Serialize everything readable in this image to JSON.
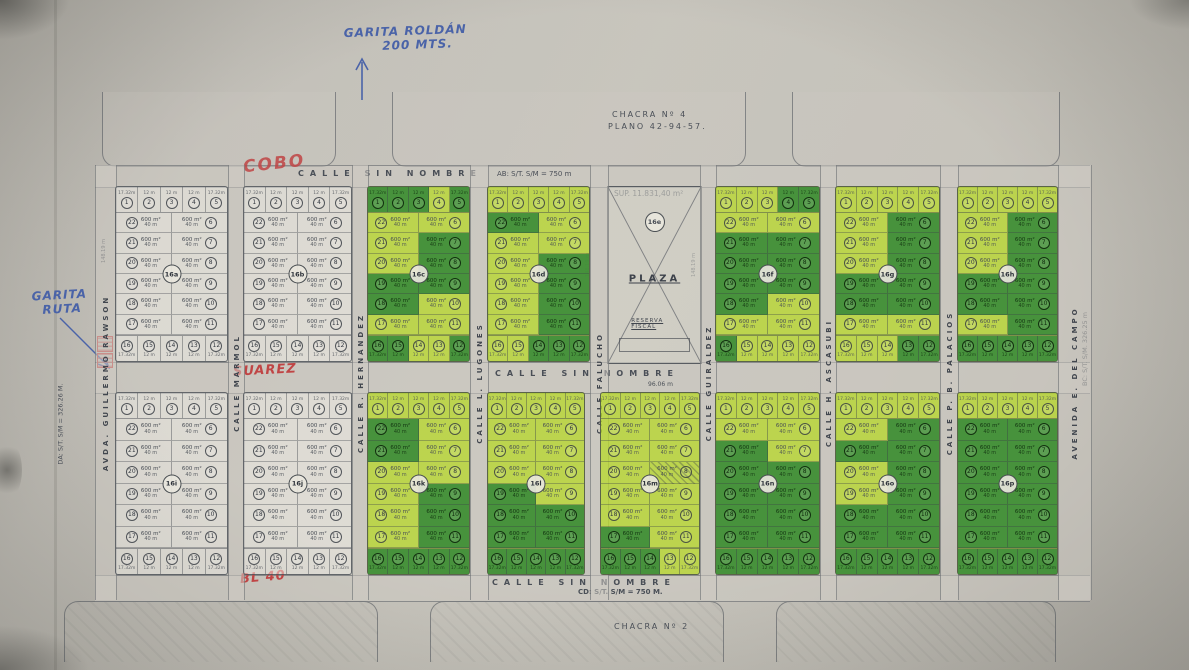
{
  "chacras": {
    "top_name": "CHACRA Nº 4",
    "top_plano": "PLANO 42-94-57.",
    "bottom_name": "CHACRA Nº 2"
  },
  "annotations": {
    "garita_roldan_line1": "GARITA ROLDÁN",
    "garita_roldan_line2": "200 MTS.",
    "garita_ruta_line1": "GARITA",
    "garita_ruta_line2": "RUTA",
    "red_cobo": "COBO",
    "red_suarez": "SUAREZ",
    "red_bl40": "BL 40"
  },
  "measurements": {
    "top_edge": "AB: S/T. S/M = 750 m",
    "bottom_edge": "CD: S/T. S/M = 750 M.",
    "left_edge": "DA: S/T. S/M = 326.26 M.",
    "right_edge": "BC: S/T. S/M. 326.25 m",
    "superficie": "SUP. 11.831,40 m²",
    "block_side": "148.19 m",
    "plaza_bottom": "96.06 m"
  },
  "streets": {
    "unnamed": "CALLE SIN NOMBRE",
    "vertical": [
      "AVDA. GUILLERMO RAWSON",
      "CALLE MARMOL",
      "CALLE R. HERNANDEZ",
      "CALLE L. LUGONES",
      "CALLE FALUCHO",
      "CALLE GUIRALDEZ",
      "CALLE H. ASCASUBI",
      "CALLE P. B. PALACIOS",
      "AVENIDA E. DEL CAMPO"
    ]
  },
  "plaza": {
    "label": "16e",
    "name": "PLAZA",
    "reserve": "RESERVA FISCAL"
  },
  "lot_text": {
    "area": "600 m²",
    "depth": "40 m",
    "strip_width": "12 m",
    "corner_width": "17.32m"
  },
  "numbering": {
    "top_strip": [
      1,
      2,
      3,
      4,
      5
    ],
    "left_col": [
      22,
      21,
      20,
      19,
      18,
      17
    ],
    "right_col": [
      6,
      7,
      8,
      9,
      10,
      11
    ],
    "bottom_strip": [
      16,
      15,
      14,
      13,
      12
    ]
  },
  "blocks_top": [
    {
      "label": "16a",
      "green": false,
      "darks": []
    },
    {
      "label": "16b",
      "green": false,
      "darks": []
    },
    {
      "label": "16c",
      "green": true,
      "darks": [
        1,
        2,
        3,
        5,
        7,
        8,
        9,
        18,
        19,
        12,
        15,
        16
      ]
    },
    {
      "label": "16d",
      "green": true,
      "darks": [
        8,
        9,
        10,
        11,
        12,
        13,
        14,
        22
      ]
    },
    {
      "label": "16f",
      "green": true,
      "darks": [
        4,
        5,
        7,
        8,
        9,
        16,
        18,
        19,
        20,
        21
      ]
    },
    {
      "label": "16g",
      "green": true,
      "darks": [
        6,
        7,
        8,
        9,
        10,
        12,
        13,
        18,
        19
      ]
    },
    {
      "label": "16h",
      "green": true,
      "darks": [
        6,
        7,
        8,
        9,
        10,
        11,
        12,
        13,
        14,
        15,
        16,
        18,
        19
      ]
    }
  ],
  "blocks_bottom": [
    {
      "label": "16i",
      "green": false,
      "darks": []
    },
    {
      "label": "16j",
      "green": false,
      "darks": []
    },
    {
      "label": "16k",
      "green": true,
      "darks": [
        9,
        10,
        11,
        12,
        13,
        14,
        15,
        16,
        21,
        22
      ]
    },
    {
      "label": "16l",
      "green": true,
      "darks": [
        10,
        11,
        12,
        13,
        14,
        15,
        16,
        17,
        18,
        19
      ]
    },
    {
      "label": "16m",
      "green": true,
      "darks": [
        14,
        15,
        16,
        17
      ],
      "hatched": [
        8
      ]
    },
    {
      "label": "16n",
      "green": true,
      "darks": [
        8,
        9,
        10,
        11,
        12,
        13,
        14,
        15,
        16,
        17,
        18,
        19,
        20,
        21
      ]
    },
    {
      "label": "16o",
      "green": true,
      "darks": [
        6,
        7,
        8,
        9,
        10,
        11,
        12,
        13,
        14,
        15,
        16,
        17,
        18,
        21
      ]
    },
    {
      "label": "16p",
      "green": true,
      "darks": [
        6,
        7,
        8,
        9,
        10,
        11,
        12,
        13,
        14,
        15,
        16,
        17,
        18,
        19,
        20,
        21,
        22
      ]
    }
  ],
  "colors": {
    "highlight_light": "#b8d82f",
    "highlight_dark": "#37893a",
    "ink": "#4a4f57",
    "blue_pen": "#4a63a8",
    "red_pen": "#c04545"
  }
}
